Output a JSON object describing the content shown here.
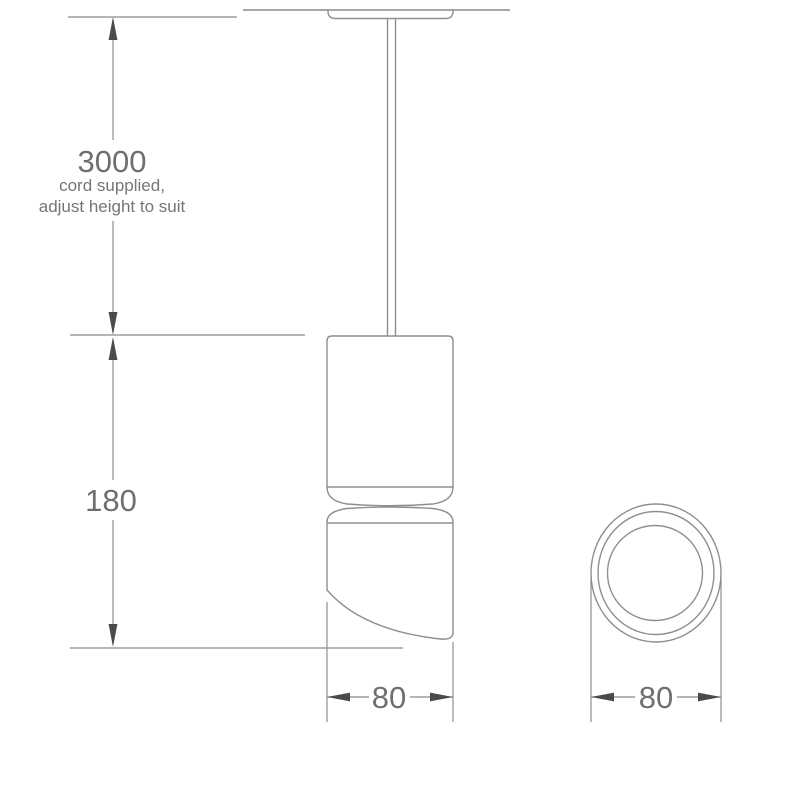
{
  "drawing": {
    "kind": "technical-line-drawing",
    "subject": "pendant cylinder spotlight - front elevation with ceiling canopy and cord, plus bottom circular view",
    "colors": {
      "background": "#ffffff",
      "outline": "#8f8f8f",
      "dimension_line": "#8a8a8a",
      "arrowhead": "#4a4a4a",
      "text": "#6f6f6f"
    },
    "dimensions": {
      "cord": {
        "value": "3000",
        "note1": "cord supplied,",
        "note2": "adjust height to suit"
      },
      "fixture_height": {
        "value": "180"
      },
      "fixture_width_front": {
        "value": "80"
      },
      "fixture_diameter_bottom": {
        "value": "80"
      }
    }
  }
}
